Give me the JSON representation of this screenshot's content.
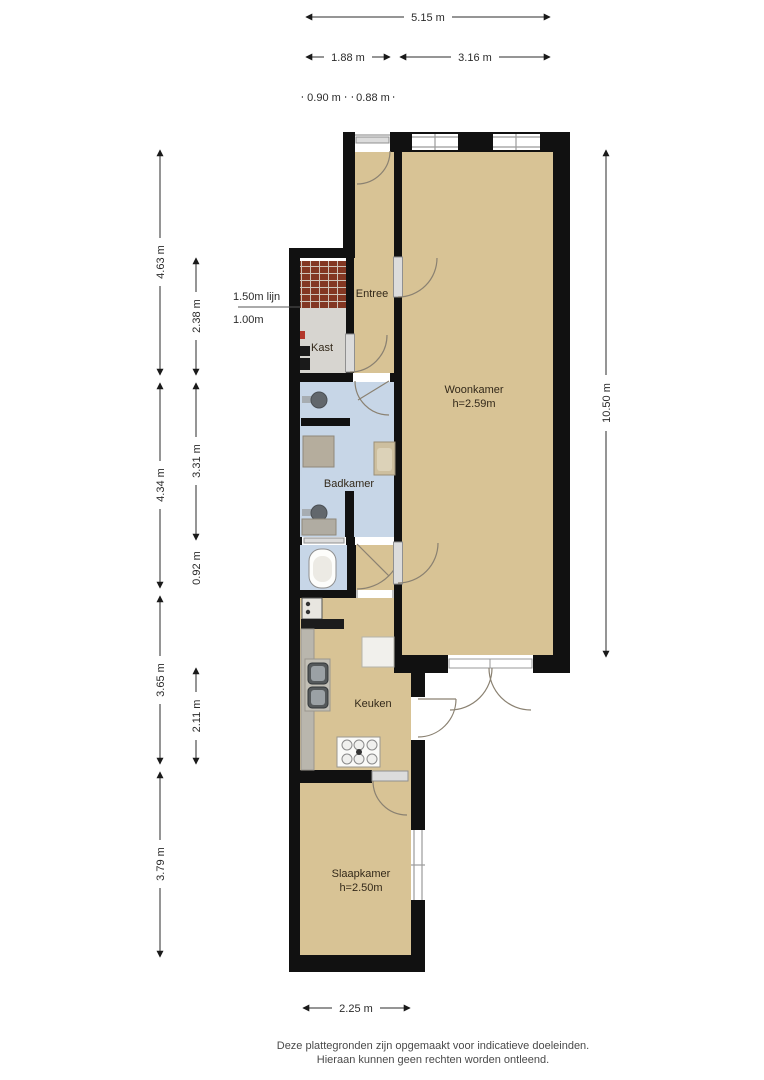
{
  "rooms": {
    "entree": {
      "label": "Entree"
    },
    "kast": {
      "label": "Kast"
    },
    "badkamer": {
      "label": "Badkamer"
    },
    "woonkamer": {
      "label": "Woonkamer",
      "height": "h=2.59m"
    },
    "keuken": {
      "label": "Keuken"
    },
    "slaapkamer": {
      "label": "Slaapkamer",
      "height": "h=2.50m"
    }
  },
  "dimensions": {
    "top_total": "5.15 m",
    "top_left": "1.88 m",
    "top_right": "3.16 m",
    "top_small_left": "0.90 m",
    "top_small_right": "0.88 m",
    "left_outer": [
      "4.63 m",
      "4.34 m",
      "3.65 m",
      "3.79 m"
    ],
    "left_inner": [
      "2.38 m",
      "3.31 m",
      "0.92 m",
      "2.11 m"
    ],
    "right_total": "10.50 m",
    "bottom": "2.25 m",
    "note_line": "1.50m lijn",
    "note_height": "1.00m"
  },
  "footer": {
    "line1": "Deze plattegronden zijn opgemaakt voor indicatieve doeleinden.",
    "line2": "Hieraan kunnen geen rechten worden ontleend."
  },
  "colors": {
    "floor": "#d8c395",
    "bathroom": "#c7d6e7",
    "closet": "#d7d5d0",
    "brick": "#833723",
    "brick_grout": "#cfc5ba",
    "wall": "#111111",
    "counter": "#b9b6ad",
    "shower": "#b5ad9d"
  }
}
